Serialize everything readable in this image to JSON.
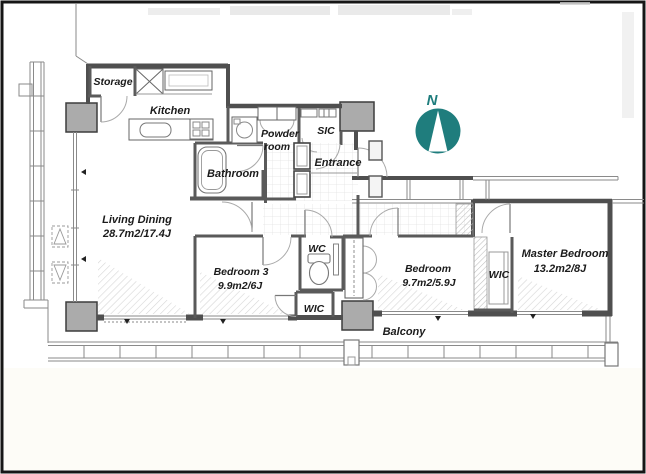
{
  "plan": {
    "rooms": {
      "storage": {
        "label": "Storage"
      },
      "kitchen": {
        "label": "Kitchen"
      },
      "powder_room": {
        "line1": "Powder",
        "line2": "room"
      },
      "bathroom": {
        "label": "Bathroom"
      },
      "sic": {
        "label": "SIC"
      },
      "entrance": {
        "label": "Entrance"
      },
      "living_dining": {
        "label": "Living Dining",
        "area": "28.7m2/17.4J"
      },
      "bedroom3": {
        "label": "Bedroom 3",
        "area": "9.9m2/6J"
      },
      "wc": {
        "label": "WC"
      },
      "wic_hall": {
        "label": "WIC"
      },
      "bedroom2": {
        "label": "Bedroom",
        "area": "9.7m2/5.9J"
      },
      "wic_master": {
        "label": "WIC"
      },
      "master_bedroom": {
        "label": "Master Bedroom",
        "area": "13.2m2/8J"
      },
      "balcony": {
        "label": "Balcony"
      }
    },
    "compass": {
      "label": "N",
      "color": "#1f7d7d"
    },
    "colors": {
      "wall": "#4f4f4f",
      "column_fill": "#ababab",
      "compass_teal": "#1f7d7d"
    }
  }
}
